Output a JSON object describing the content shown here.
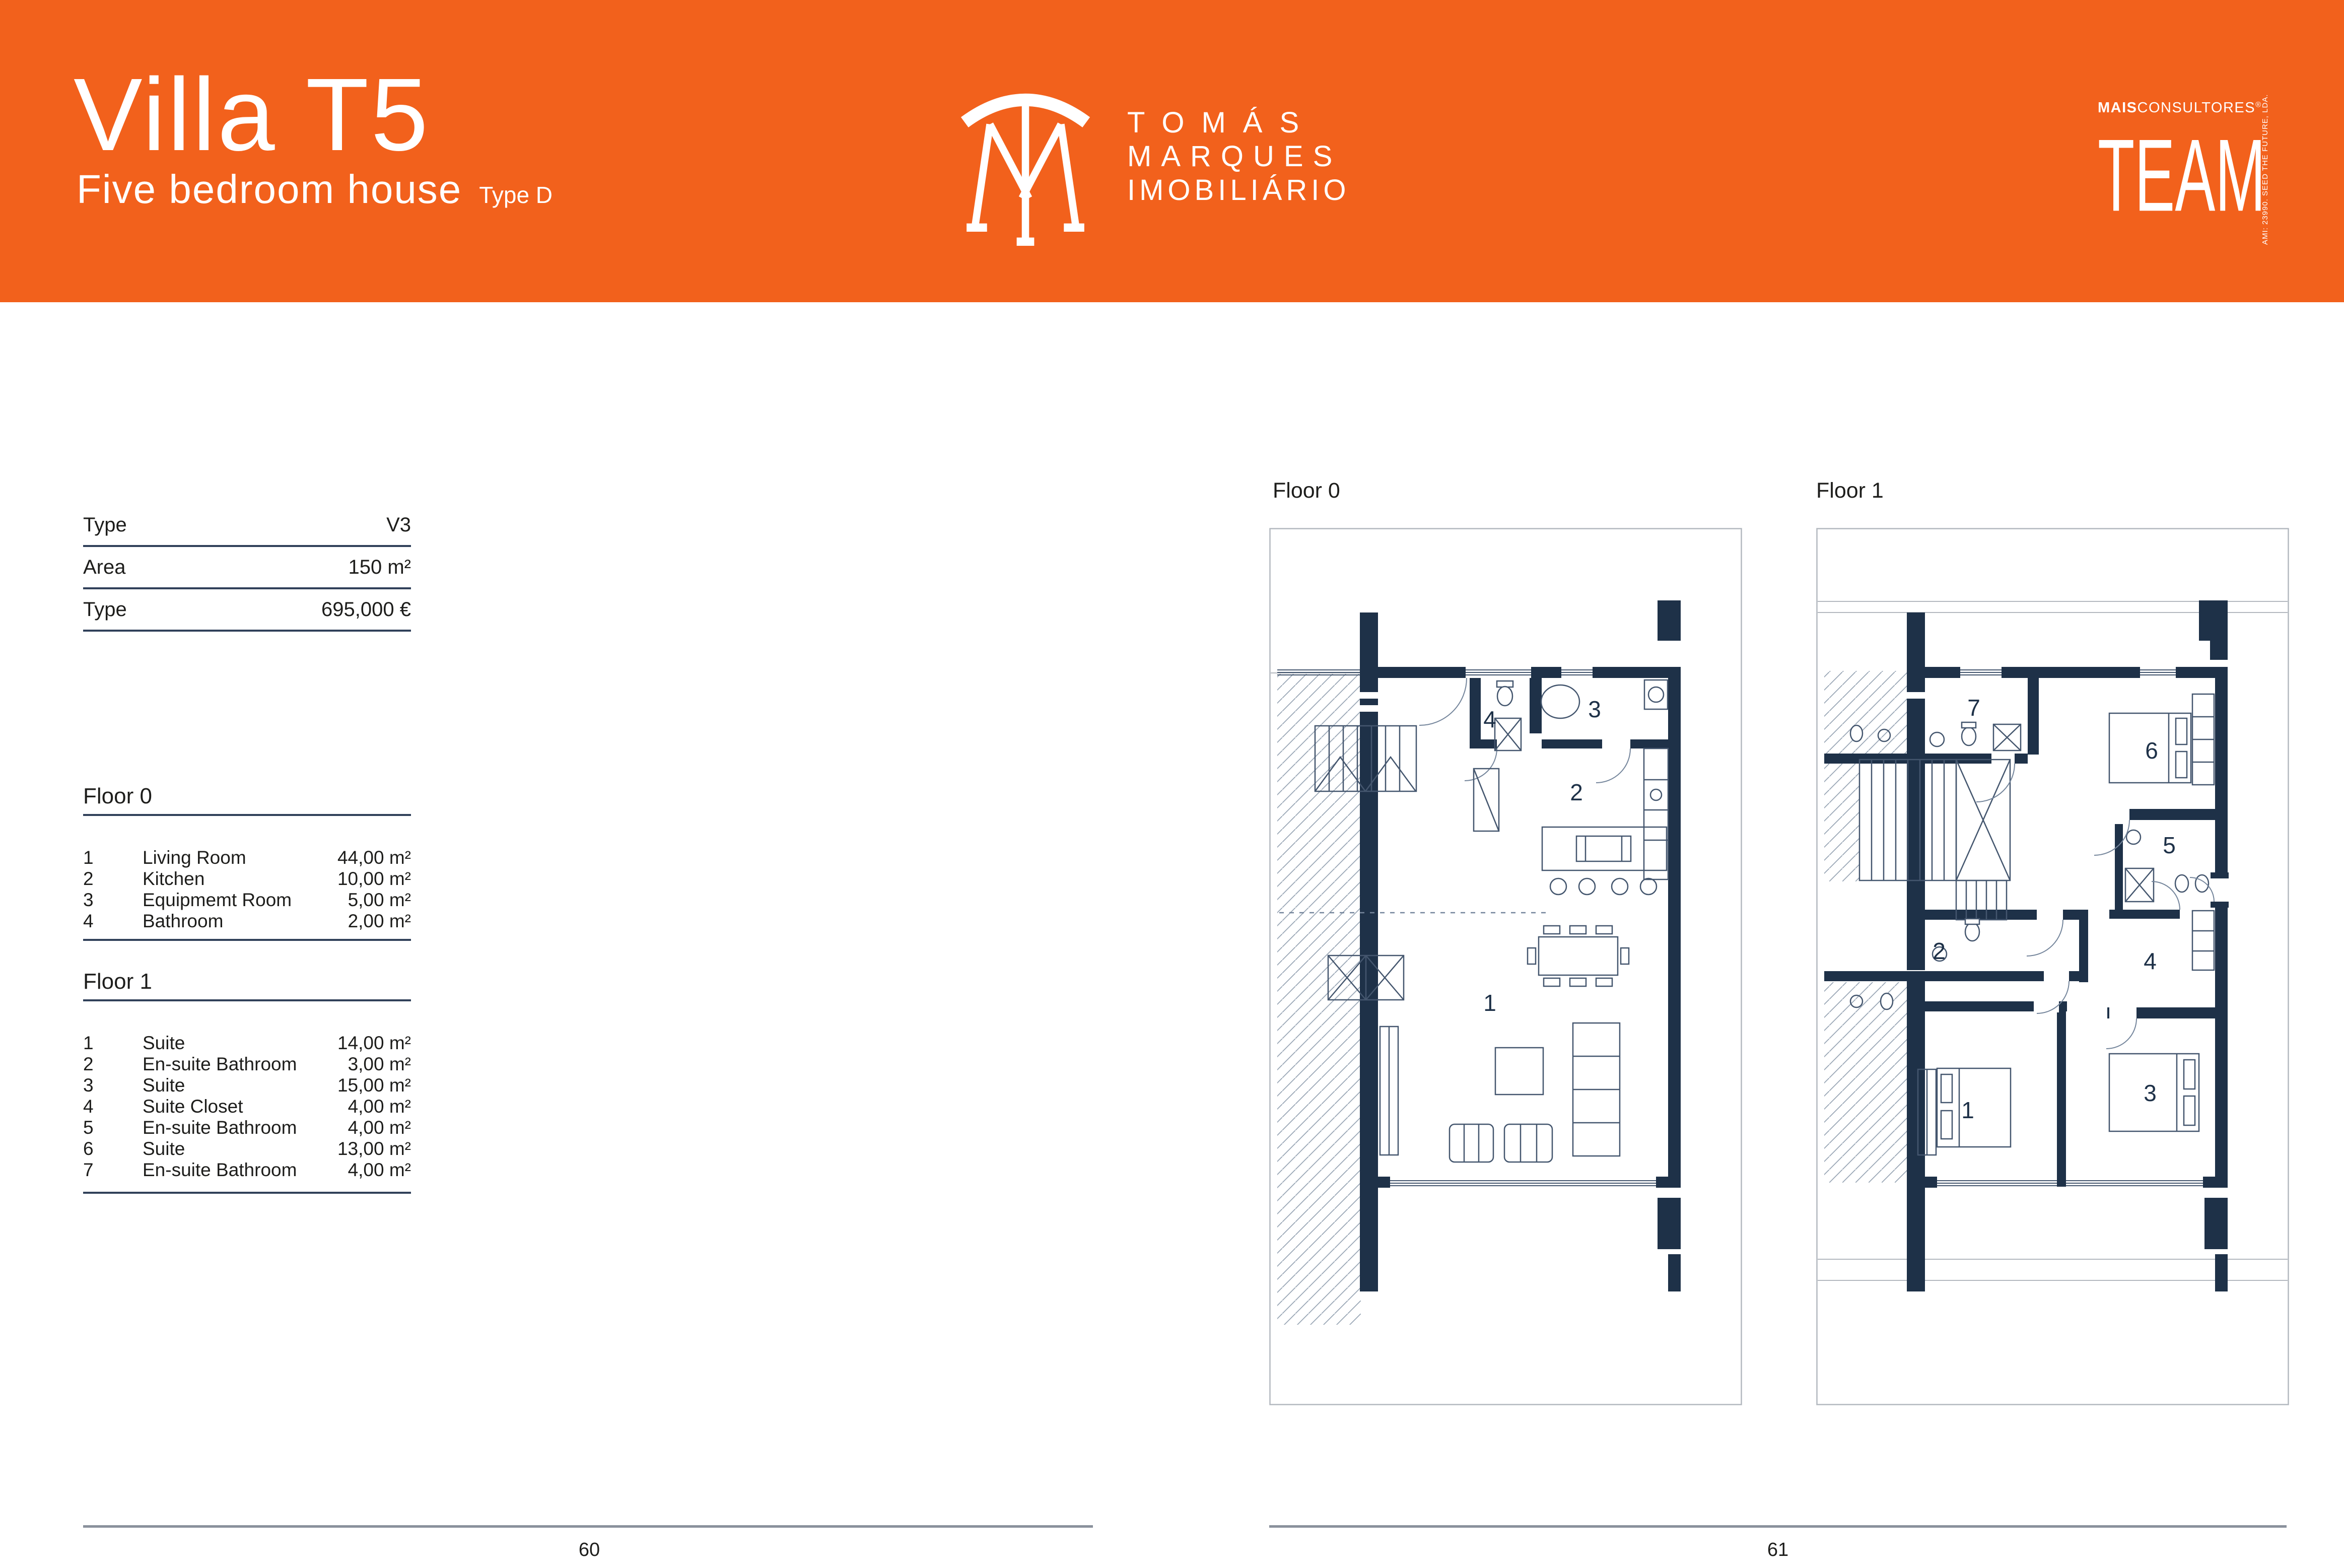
{
  "colors": {
    "header_orange": "#F2611C",
    "wall_navy": "#1E3148",
    "rule_navy": "#31415A",
    "footer_gray": "#8A919C",
    "text_dark": "#1D1D1B"
  },
  "header": {
    "title": "Villa T5",
    "subtitle": "Five bedroom house",
    "type_label": "Type D",
    "brand_line1": "TOMÁS",
    "brand_line2": "MARQUES",
    "brand_line3": "IMOBILIÁRIO",
    "agency_bold": "MAIS",
    "agency_rest": "CONSULTORES",
    "agency_reg": "®",
    "agency_team": "TEAM",
    "agency_side": "AMI: 23990. SEED THE FUTURE, LDA."
  },
  "specs": {
    "rows": [
      {
        "label": "Type",
        "value": "V3"
      },
      {
        "label": "Area",
        "value": "150 m²"
      },
      {
        "label": "Type",
        "value": "695,000 €"
      }
    ]
  },
  "floor0": {
    "heading": "Floor 0",
    "rooms": [
      {
        "num": "1",
        "name": "Living Room",
        "area": "44,00 m²"
      },
      {
        "num": "2",
        "name": "Kitchen",
        "area": "10,00 m²"
      },
      {
        "num": "3",
        "name": "Equipmemt Room",
        "area": "5,00 m²"
      },
      {
        "num": "4",
        "name": "Bathroom",
        "area": "2,00 m²"
      }
    ]
  },
  "floor1": {
    "heading": "Floor 1",
    "rooms": [
      {
        "num": "1",
        "name": "Suite",
        "area": "14,00 m²"
      },
      {
        "num": "2",
        "name": "En-suite Bathroom",
        "area": "3,00 m²"
      },
      {
        "num": "3",
        "name": "Suite",
        "area": "15,00 m²"
      },
      {
        "num": "4",
        "name": "Suite Closet",
        "area": "4,00 m²"
      },
      {
        "num": "5",
        "name": "En-suite Bathroom",
        "area": "4,00 m²"
      },
      {
        "num": "6",
        "name": "Suite",
        "area": "13,00 m²"
      },
      {
        "num": "7",
        "name": "En-suite Bathroom",
        "area": "4,00 m²"
      }
    ]
  },
  "plan0": {
    "caption": "Floor 0",
    "labels": {
      "n1": "1",
      "n2": "2",
      "n3": "3",
      "n4": "4"
    }
  },
  "plan1": {
    "caption": "Floor 1",
    "labels": {
      "n1": "1",
      "n2": "2",
      "n3": "3",
      "n4": "4",
      "n5": "5",
      "n6": "6",
      "n7": "7"
    }
  },
  "footer": {
    "left_page": "60",
    "right_page": "61"
  }
}
